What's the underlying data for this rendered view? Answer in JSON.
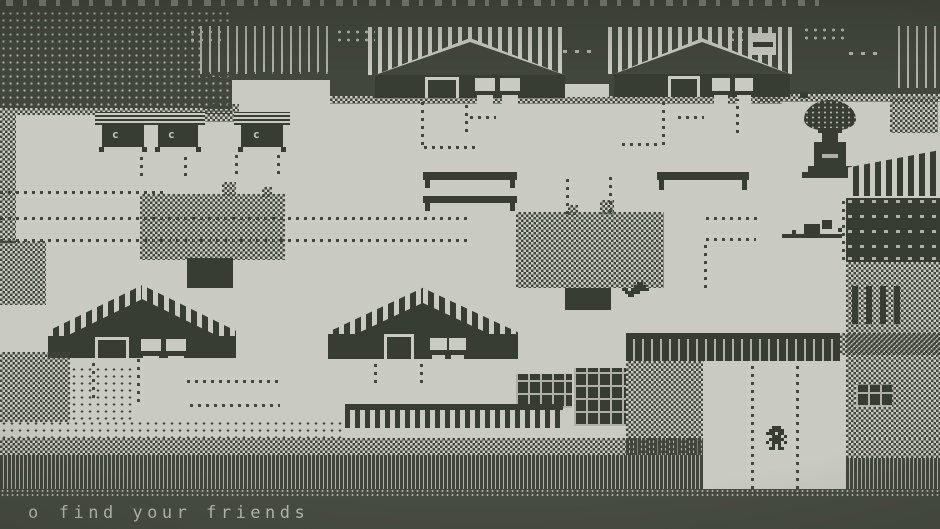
{
  "palette": {
    "dark": "#42473b",
    "dark2": "#383d31",
    "light": "#c9cbc0",
    "light-dim": "#aeb1a4",
    "bar": "#474c40",
    "ink": "#c2c5b8"
  },
  "hud": {
    "bullet": "o",
    "message": "find your friends"
  },
  "stalls": {
    "door_glyph": "c"
  }
}
